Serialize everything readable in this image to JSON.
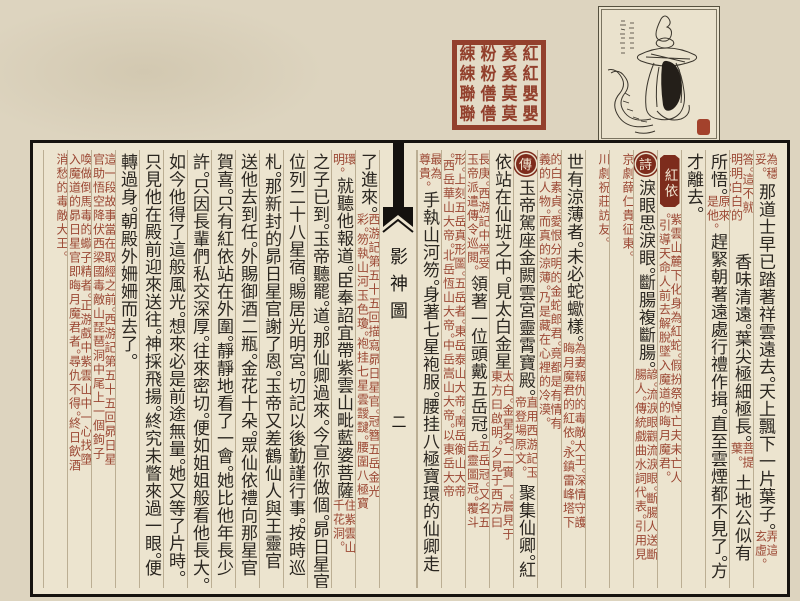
{
  "seal": {
    "name": "red-square-seal",
    "rows": [
      "綀粉奚紅",
      "綀粉奚紅",
      "聯僐莫嬰",
      "聯僐莫嬰"
    ],
    "color": "#93402d"
  },
  "illustration": {
    "subject": "snake-bodied woman figure (Hong Yi)",
    "has_caption_strokes": true,
    "mini_seal_color": "#a3422c"
  },
  "page": {
    "background": "#ece4cf",
    "main_text_color": "#2b2721",
    "commentary_color": "#9b4733",
    "badge_color": "#7d2c1c",
    "centerfold": {
      "title": "影神圖",
      "page_number": "二"
    },
    "right_columns": [
      {
        "segments": [
          {
            "note": "為穩妥。",
            "h": 30
          },
          {
            "big": "那道士早已踏著祥雲遠去。天上飄下一片葉子。"
          },
          {
            "note": "弄這玄虛。",
            "h": 34
          }
        ]
      },
      {
        "segments": [
          {
            "note": "答。這不就明明白白的告訴你了。",
            "h": 100
          },
          {
            "big": "香味清遠。葉尖極細極長。"
          },
          {
            "note": "菩提葉。",
            "h": 32
          },
          {
            "big": "土地公似有"
          }
        ]
      },
      {
        "segments": [
          {
            "big": "所悟。"
          },
          {
            "note": "原來是他。",
            "h": 38
          },
          {
            "big": "趕緊朝著遠處行禮作揖。直至雲煙都不見了。方"
          }
        ]
      },
      {
        "segments": [
          {
            "big": "才離去。"
          }
        ]
      },
      {
        "segments": [
          {
            "title": "紅依"
          },
          {
            "note": "紫雲山麓下化身為紅蛇。假扮祭悼亡夫未亡人。引導天命人前去解脫墜入魔道的晦月魔君。",
            "h": 292
          }
        ]
      },
      {
        "segments": [
          {
            "badge": "詩"
          },
          {
            "big": "淚眼思淚眼。斷腸複斷腸。"
          },
          {
            "note": "諺。流淚眼觀流淚眼。斷腸人送斷腸人。傳統戲曲水詞代表。引用見",
            "fill": true
          }
        ]
      },
      {
        "segments": [
          {
            "note": "京劇薛仁貴征東。",
            "fill": true
          }
        ]
      },
      {
        "segments": [
          {
            "note": "川劇祝莊訪友。",
            "fill": true
          }
        ]
      },
      {
        "segments": [
          {
            "big": "世有涼薄者。未必蛇蠍樣。"
          },
          {
            "note": "為妻報仇的毒敵大王。深情守護晦月魔君的紅依。永鎮雷峰塔下",
            "fill": true
          }
        ]
      },
      {
        "segments": [
          {
            "note": "的白素貞。愛恨分明的金蛇郎君。竟都是有情有義的人物。而真的涼薄。乃是藏在心裡的冷漠。",
            "fill": true
          }
        ]
      },
      {
        "segments": [
          {
            "badge": "傳"
          },
          {
            "big": "玉帝駕座金闕雲宮靈霄寶殿。"
          },
          {
            "note": "直用西游記玉帝登場原文。",
            "h": 88
          },
          {
            "big": "聚集仙卿。紅"
          }
        ]
      },
      {
        "segments": [
          {
            "big": "依站在仙班之中。見太白金星"
          },
          {
            "note": "太白。金星名。二實一。晨見于東方曰啟明。夕見于西方曰",
            "fill": true
          }
        ]
      },
      {
        "segments": [
          {
            "note": "長庚。西游記中常受玉帝派遣傳令巡閱。",
            "h": 122
          },
          {
            "big": "領著一位頭戴五岳冠。"
          },
          {
            "note": "五岳冠。又名五岳靈圖冠。覆斗",
            "fill": true
          }
        ]
      },
      {
        "segments": [
          {
            "note": "形。上刻五岳真形圖。五岳者。東岳泰山大帝。南岳衡山大帝。西岳華山大帝。北岳恆山大帝。中岳嵩山大帝。以東岳大帝",
            "h": 400
          }
        ]
      },
      {
        "segments": [
          {
            "note": "最為尊貴。",
            "h": 38
          },
          {
            "big": "手執山河笏。身著七星袍服。腰挂八極寶環的仙卿走"
          }
        ]
      }
    ],
    "left_columns": [
      {
        "segments": [
          {
            "big": "了進來。"
          },
          {
            "note": "西游記第五十五回描寫昴日星官。冠簪五岳金光彩。笏執山河玉色瓊。袍挂七星雲靉靆。腰圍八極寶",
            "fill": true
          }
        ]
      },
      {
        "segments": [
          {
            "note": "環明。",
            "h": 24
          },
          {
            "big": "就聽他報道。臣奉詔宜帶紫雲山毗藍婆菩薩"
          },
          {
            "note": "住紫雲山千花洞。",
            "fill": true
          }
        ]
      },
      {
        "segments": [
          {
            "big": "之子已到。玉帝聽罷。道。那仙卿過來。今宣你做個。昴日星官。"
          }
        ]
      },
      {
        "segments": [
          {
            "big": "位列二十八星宿。賜居光明宮。切記以後勤謹行事。按時巡"
          }
        ]
      },
      {
        "segments": [
          {
            "big": "札。那新封的昴日星官謝了恩。玉帝又差鶴仙人與王靈官"
          }
        ]
      },
      {
        "segments": [
          {
            "big": "送他去到任。外賜御酒二瓶。金花十朵。眾仙依禮向那星官"
          }
        ]
      },
      {
        "segments": [
          {
            "big": "賀喜。只有紅依站在外圍。靜靜地看了一會。她比他年長少"
          }
        ]
      },
      {
        "segments": [
          {
            "big": "許。只因長輩們私交深厚。往來密切。便如姐姐般看他長大。"
          }
        ]
      },
      {
        "segments": [
          {
            "big": "如今他得了這般風光。想來必是前途無量。她又等了片時。"
          }
        ]
      },
      {
        "segments": [
          {
            "big": "只見他在殿前迎來送往。神採飛揚。終究未瞥來過一眼。便"
          }
        ]
      },
      {
        "segments": [
          {
            "big": "轉過身。朝殿外姍姍而去了。"
          }
        ]
      },
      {
        "segments": [
          {
            "note": "這一段故事當在取經之前。西游記第五十五回昴日星官助悟空降伏西梁國毒敵山琵琶洞中尾上一個鉤子",
            "h": 330
          }
        ]
      },
      {
        "segments": [
          {
            "note": "喚做倒馬毒的蠍子精者。正游戲中紫雲山中一心找墮入魔道的昴日星官即晦月魔君者。尋仇不得。終日飲酒",
            "h": 345
          }
        ]
      },
      {
        "segments": [
          {
            "note": "消愁的毒敵大王。",
            "fill": true
          }
        ]
      }
    ]
  }
}
